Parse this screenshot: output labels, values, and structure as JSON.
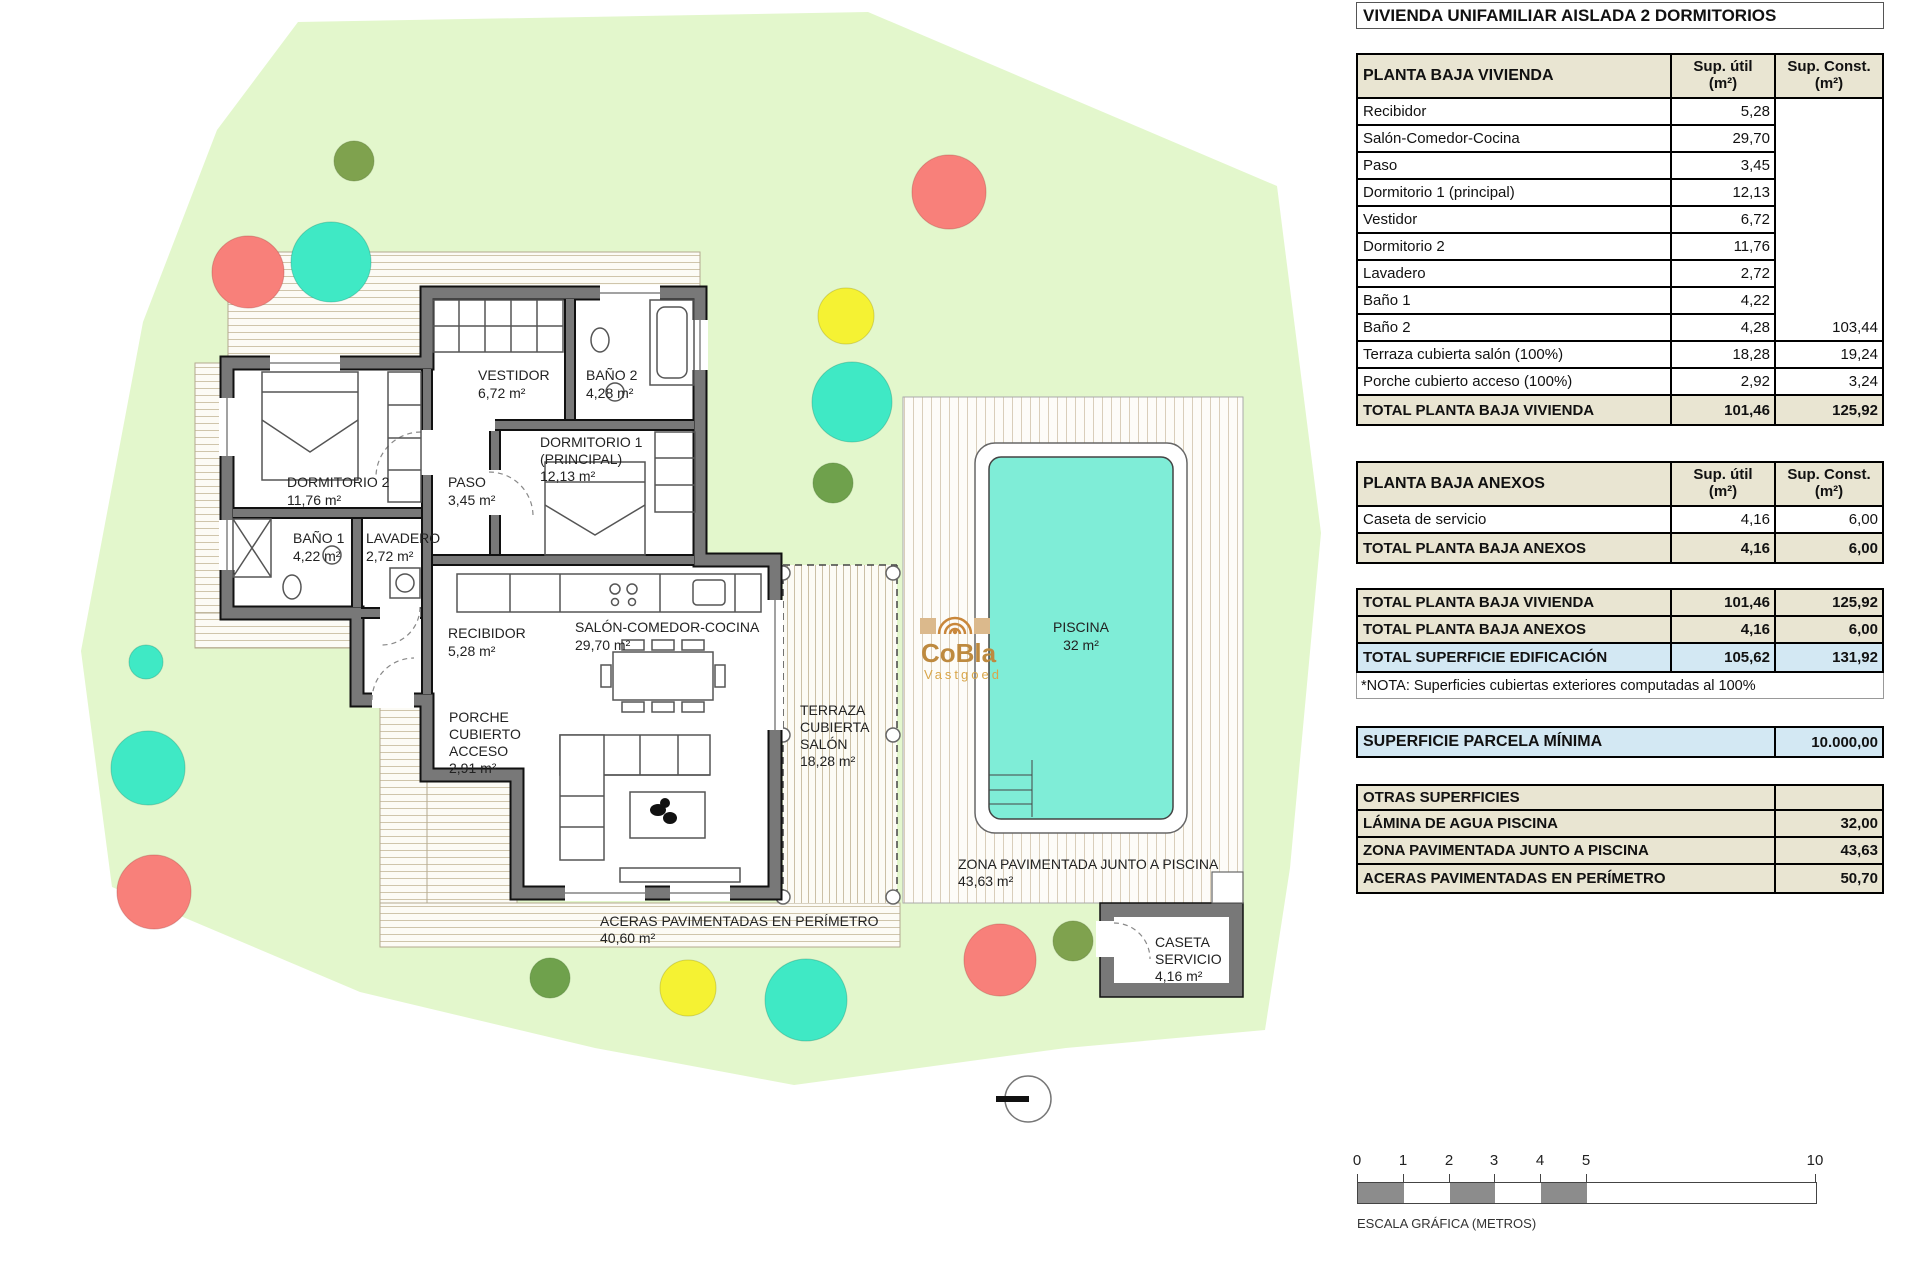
{
  "header": {
    "title": "VIVIENDA UNIFAMILIAR AISLADA 2 DORMITORIOS"
  },
  "columns": {
    "util": "Sup. útil\n(m²)",
    "const": "Sup. Const.\n(m²)"
  },
  "vivienda": {
    "header": "PLANTA BAJA VIVIENDA",
    "rows": [
      {
        "label": "Recibidor",
        "util": "5,28",
        "const": ""
      },
      {
        "label": "Salón-Comedor-Cocina",
        "util": "29,70",
        "const": ""
      },
      {
        "label": "Paso",
        "util": "3,45",
        "const": ""
      },
      {
        "label": "Dormitorio 1 (principal)",
        "util": "12,13",
        "const": ""
      },
      {
        "label": "Vestidor",
        "util": "6,72",
        "const": ""
      },
      {
        "label": "Dormitorio 2",
        "util": "11,76",
        "const": ""
      },
      {
        "label": "Lavadero",
        "util": "2,72",
        "const": ""
      },
      {
        "label": "Baño 1",
        "util": "4,22",
        "const": ""
      },
      {
        "label": "Baño 2",
        "util": "4,28",
        "const": "103,44"
      },
      {
        "label": "Terraza cubierta salón (100%)",
        "util": "18,28",
        "const": "19,24"
      },
      {
        "label": "Porche cubierto acceso (100%)",
        "util": "2,92",
        "const": "3,24"
      }
    ],
    "total": {
      "label": "TOTAL PLANTA BAJA VIVIENDA",
      "util": "101,46",
      "const": "125,92"
    }
  },
  "anexos": {
    "header": "PLANTA BAJA ANEXOS",
    "rows": [
      {
        "label": "Caseta de servicio",
        "util": "4,16",
        "const": "6,00"
      }
    ],
    "total": {
      "label": "TOTAL PLANTA BAJA ANEXOS",
      "util": "4,16",
      "const": "6,00"
    }
  },
  "summary": {
    "vivienda": {
      "label": "TOTAL PLANTA BAJA VIVIENDA",
      "util": "101,46",
      "const": "125,92"
    },
    "anexos": {
      "label": "TOTAL PLANTA BAJA ANEXOS",
      "util": "4,16",
      "const": "6,00"
    },
    "edificacion": {
      "label": "TOTAL SUPERFICIE EDIFICACIÓN",
      "util": "105,62",
      "const": "131,92"
    },
    "note": "*NOTA: Superficies cubiertas exteriores computadas al 100%"
  },
  "parcela": {
    "label": "SUPERFICIE PARCELA MÍNIMA",
    "value": "10.000,00"
  },
  "otras": {
    "header": "OTRAS SUPERFICIES",
    "rows": [
      {
        "label": "LÁMINA DE AGUA PISCINA",
        "value": "32,00"
      },
      {
        "label": "ZONA PAVIMENTADA JUNTO A PISCINA",
        "value": "43,63"
      },
      {
        "label": "ACERAS PAVIMENTADAS EN PERÍMETRO",
        "value": "50,70"
      }
    ]
  },
  "scale": {
    "ticks": [
      "0",
      "1",
      "2",
      "3",
      "4",
      "5",
      "10"
    ],
    "caption": "ESCALA GRÁFICA (METROS)"
  },
  "plan": {
    "colors": {
      "parcel": "#E3F7CC",
      "pool": "#7FEDD7",
      "wall": "#787878",
      "tree_red": "#F8807A",
      "tree_teal": "#3FE9C5",
      "tree_yellow": "#F5F233",
      "tree_olive": "#7FA24E",
      "tree_green": "#6FA14C"
    },
    "labels": {
      "dormitorio2": [
        "DORMITORIO 2",
        "11,76 m²"
      ],
      "paso": [
        "PASO",
        "3,45 m²"
      ],
      "vestidor": [
        "VESTIDOR",
        "6,72 m²"
      ],
      "bano2": [
        "BAÑO 2",
        "4,28 m²"
      ],
      "dormitorio1": [
        "DORMITORIO 1",
        "(PRINCIPAL)",
        "12,13 m²"
      ],
      "bano1": [
        "BAÑO 1",
        "4,22 m²"
      ],
      "lavadero": [
        "LAVADERO",
        "2,72 m²"
      ],
      "recibidor": [
        "RECIBIDOR",
        "5,28 m²"
      ],
      "salon": [
        "SALÓN-COMEDOR-COCINA",
        "29,70 m²"
      ],
      "porche": [
        "PORCHE",
        "CUBIERTO",
        "ACCESO",
        "2,91 m²"
      ],
      "terraza": [
        "TERRAZA",
        "CUBIERTA",
        "SALÓN",
        "18,28 m²"
      ],
      "piscina": [
        "PISCINA",
        "32 m²"
      ],
      "zona": [
        "ZONA PAVIMENTADA JUNTO A PISCINA",
        "43,63 m²"
      ],
      "aceras": [
        "ACERAS PAVIMENTADAS EN PERÍMETRO",
        "40,60 m²"
      ],
      "caseta": [
        "CASETA",
        "SERVICIO",
        "4,16 m²"
      ]
    },
    "watermark": {
      "name": "CoBla",
      "sub": "Vastgoed"
    }
  }
}
